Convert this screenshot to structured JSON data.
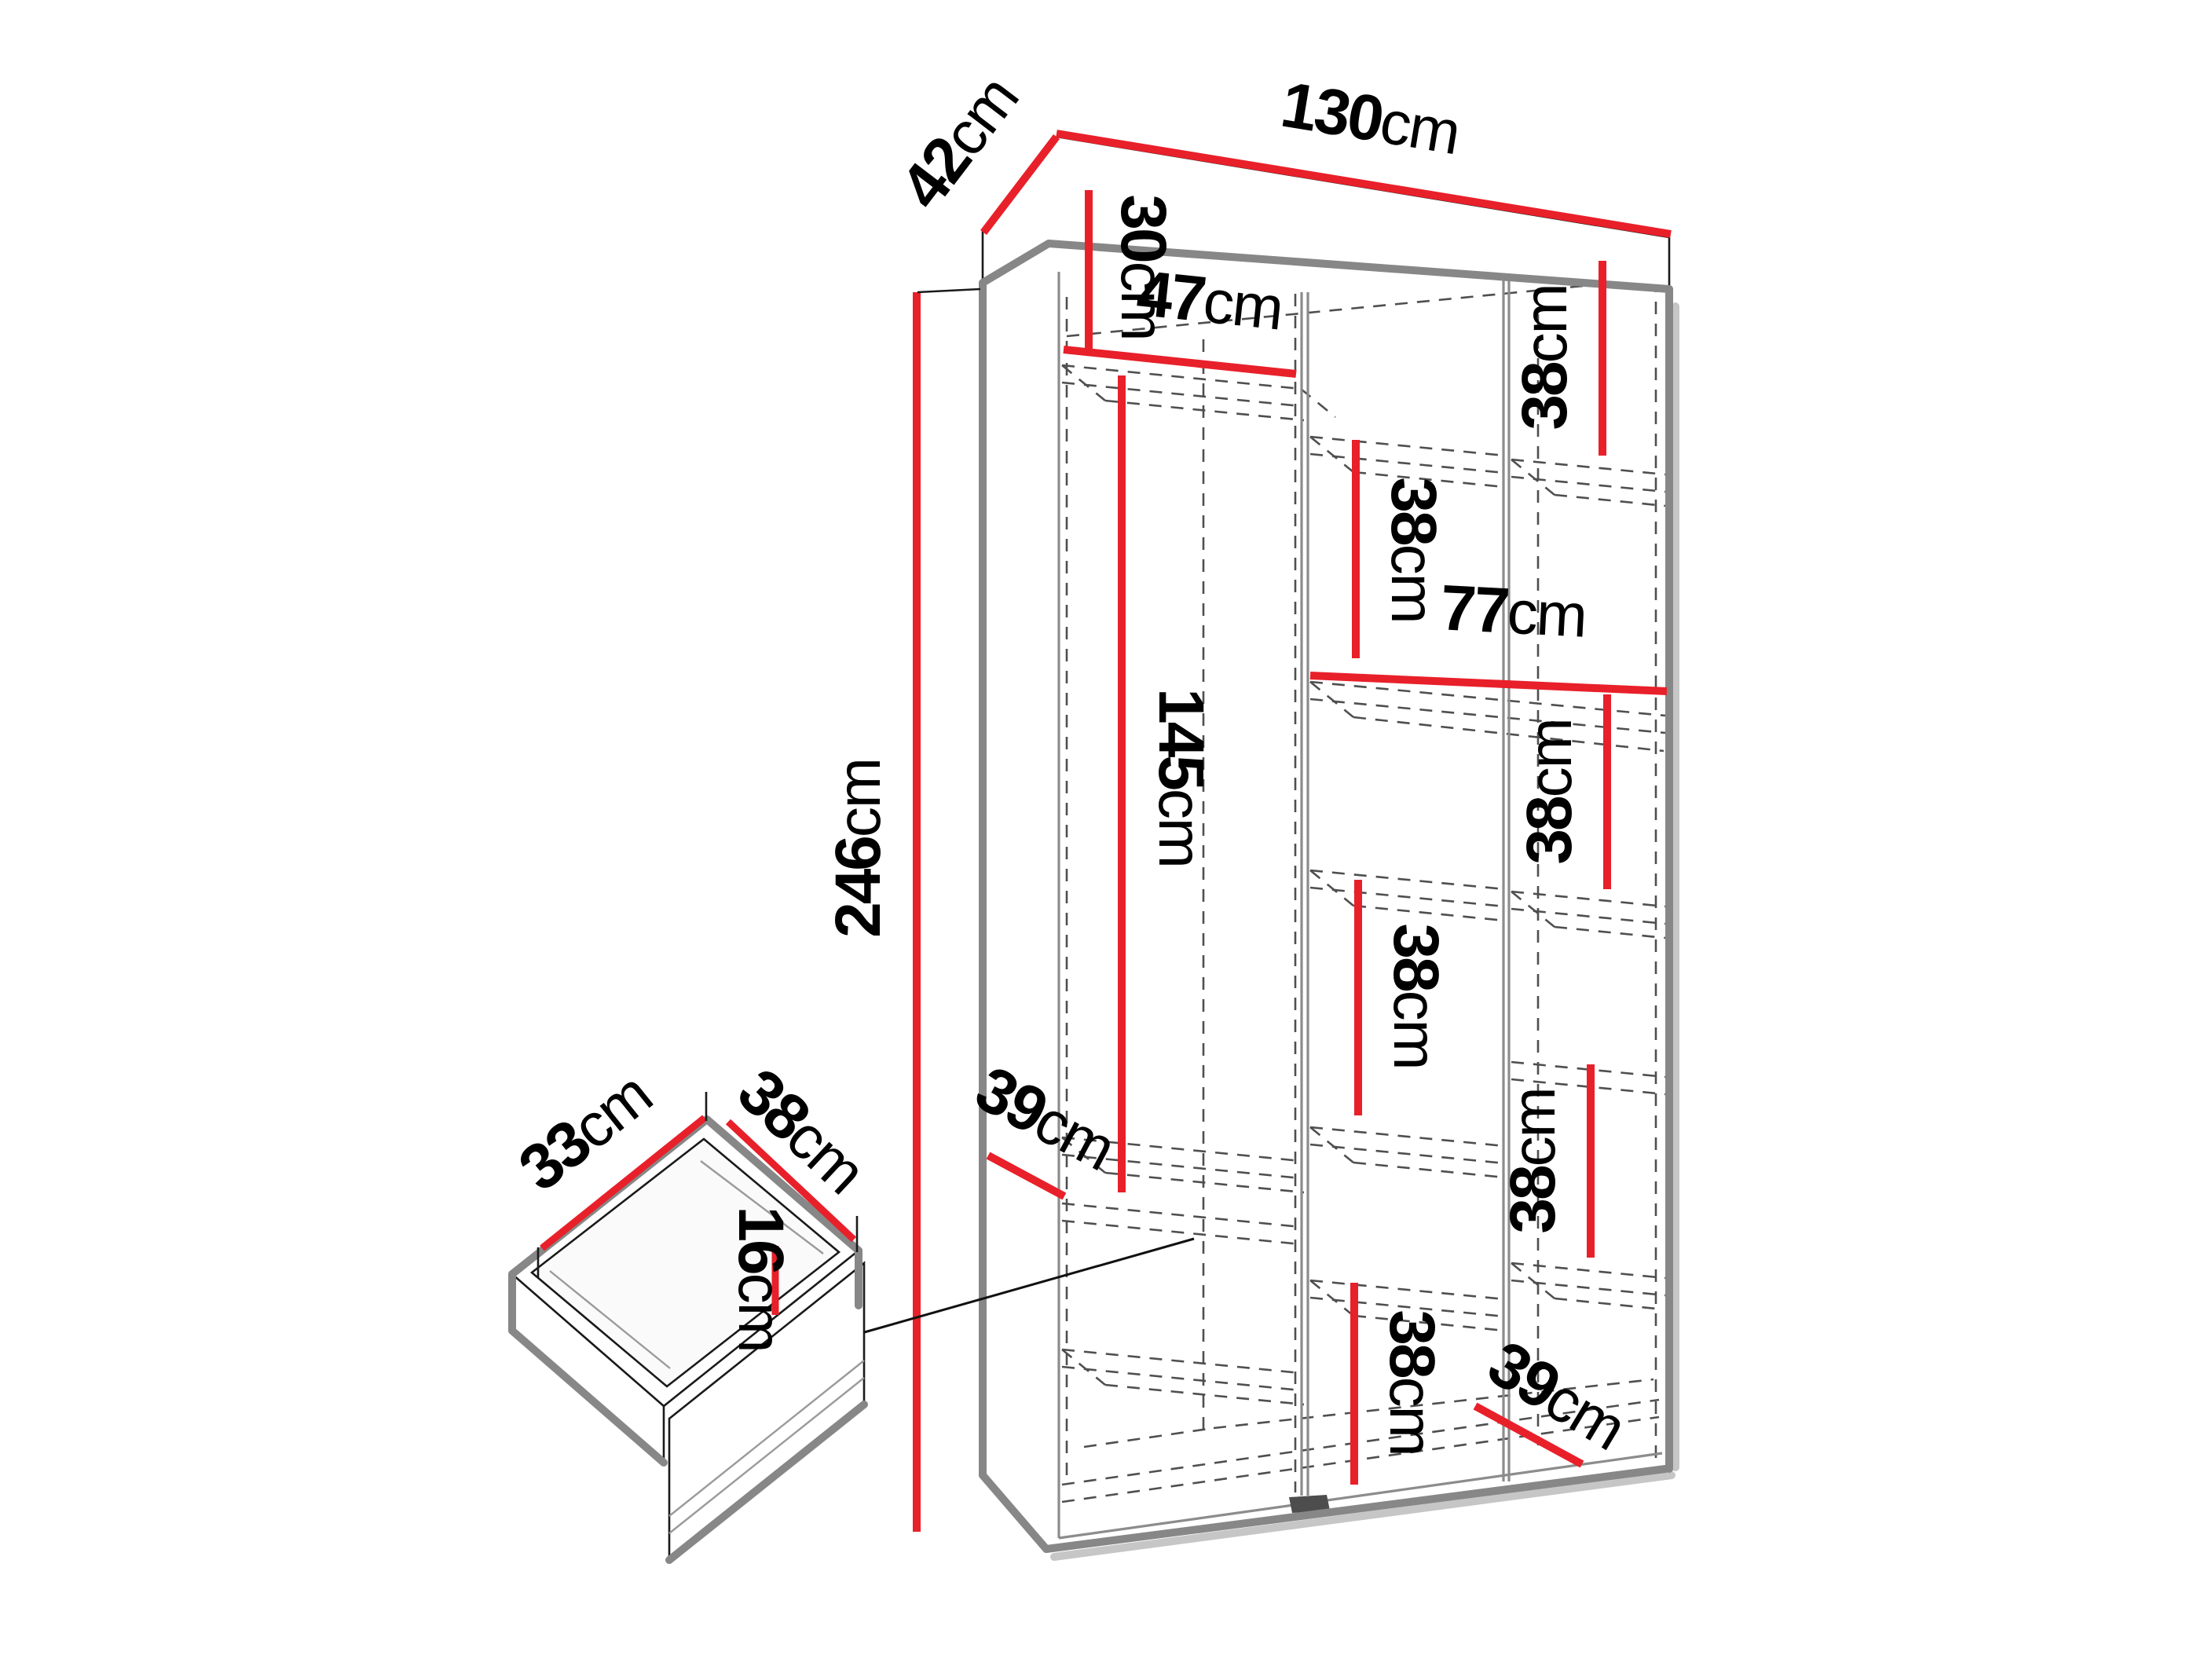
{
  "diagram": {
    "kind": "furniture-dimension-diagram",
    "subject": "wardrobe-with-shelves-and-drawer",
    "unit": "cm",
    "accent_color": "#e8202a",
    "edge_color": "#878787",
    "dashed_color": "#4f4f4f",
    "dimensions_cm": {
      "overall_width": 130,
      "overall_depth": 42,
      "overall_height": 246,
      "top_compartment_height": 30,
      "left_section_width": 47,
      "hanging_section_height": 145,
      "wide_shelf_width": 77,
      "shelf_spacing": 38,
      "left_shelf_depth": 39,
      "right_shelf_depth": 39,
      "drawer_width": 33,
      "drawer_depth": 38,
      "drawer_height": 16
    },
    "labels": {
      "width": {
        "num": "130",
        "unit": "cm"
      },
      "depth": {
        "num": "42",
        "unit": "cm"
      },
      "height": {
        "num": "246",
        "unit": "cm"
      },
      "top30": {
        "num": "30",
        "unit": "cm"
      },
      "left47": {
        "num": "47",
        "unit": "cm"
      },
      "hang145": {
        "num": "145",
        "unit": "cm"
      },
      "right38top": {
        "num": "38",
        "unit": "cm"
      },
      "mid38top": {
        "num": "38",
        "unit": "cm"
      },
      "wide77": {
        "num": "77",
        "unit": "cm"
      },
      "right38mid": {
        "num": "38",
        "unit": "cm"
      },
      "mid38mid": {
        "num": "38",
        "unit": "cm"
      },
      "right38low": {
        "num": "38",
        "unit": "cm"
      },
      "left39": {
        "num": "39",
        "unit": "cm"
      },
      "mid38bottom": {
        "num": "38",
        "unit": "cm"
      },
      "right39": {
        "num": "39",
        "unit": "cm"
      },
      "drawer33": {
        "num": "33",
        "unit": "cm"
      },
      "drawer38": {
        "num": "38",
        "unit": "cm"
      },
      "drawer16": {
        "num": "16",
        "unit": "cm"
      }
    }
  }
}
